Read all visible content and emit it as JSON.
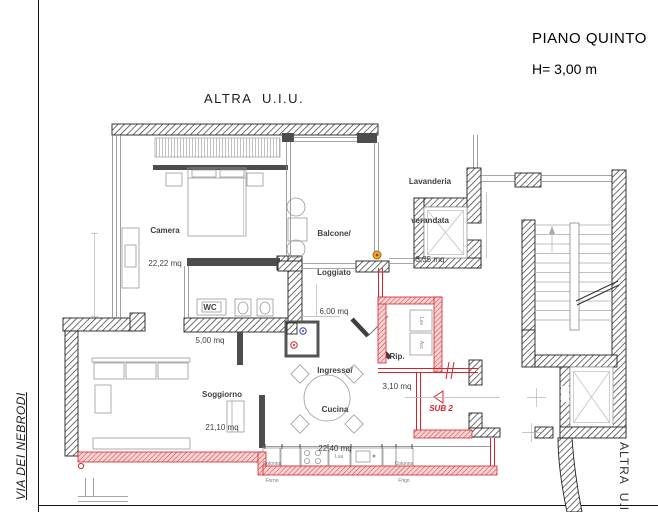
{
  "header": {
    "title": "PIANO QUINTO",
    "floor_height": "H= 3,00 m"
  },
  "context": {
    "top_unit": "ALTRA  U.I.U.",
    "right_unit": "ALTRA  U.I.U.",
    "street": "VIA DEI NEBRODI"
  },
  "rooms": {
    "camera": {
      "name": "Camera",
      "area": "22,22 mq"
    },
    "balcone": {
      "name_line1": "Balcone/",
      "name_line2": "Loggiato",
      "area": "6,00 mq"
    },
    "wc": {
      "name": "WC",
      "area": "5,00 mq"
    },
    "ingresso": {
      "name_line1": "Ingresso/",
      "name_line2": "Cucina",
      "area": "22,40 mq"
    },
    "soggiorno": {
      "name": "Soggiorno",
      "area": "21,10 mq"
    },
    "rip": {
      "name": "Rip.",
      "area": "3,10 mq"
    },
    "lavanderia": {
      "name_line1": "Lavanderia",
      "name_line2": "verandata",
      "area": "3,35 mq"
    }
  },
  "annotations": {
    "sub_label": "SUB 2",
    "kitchen_oven_line1": "Colonna",
    "kitchen_oven_line2": "Forno",
    "kitchen_dishwasher": "Lva",
    "kitchen_fridge_line1": "Colonna",
    "kitchen_fridge_line2": "Frigo",
    "rip_washer": "Lav",
    "rip_dryer": "Asc"
  },
  "colors": {
    "new_construction_red": "#d6232a",
    "new_construction_fill": "#f7d4d4",
    "existing_wall": "#2b2b2b",
    "marker_orange": "#f5a623",
    "marker_blue": "#3540c0",
    "marker_red": "#d6232a"
  }
}
